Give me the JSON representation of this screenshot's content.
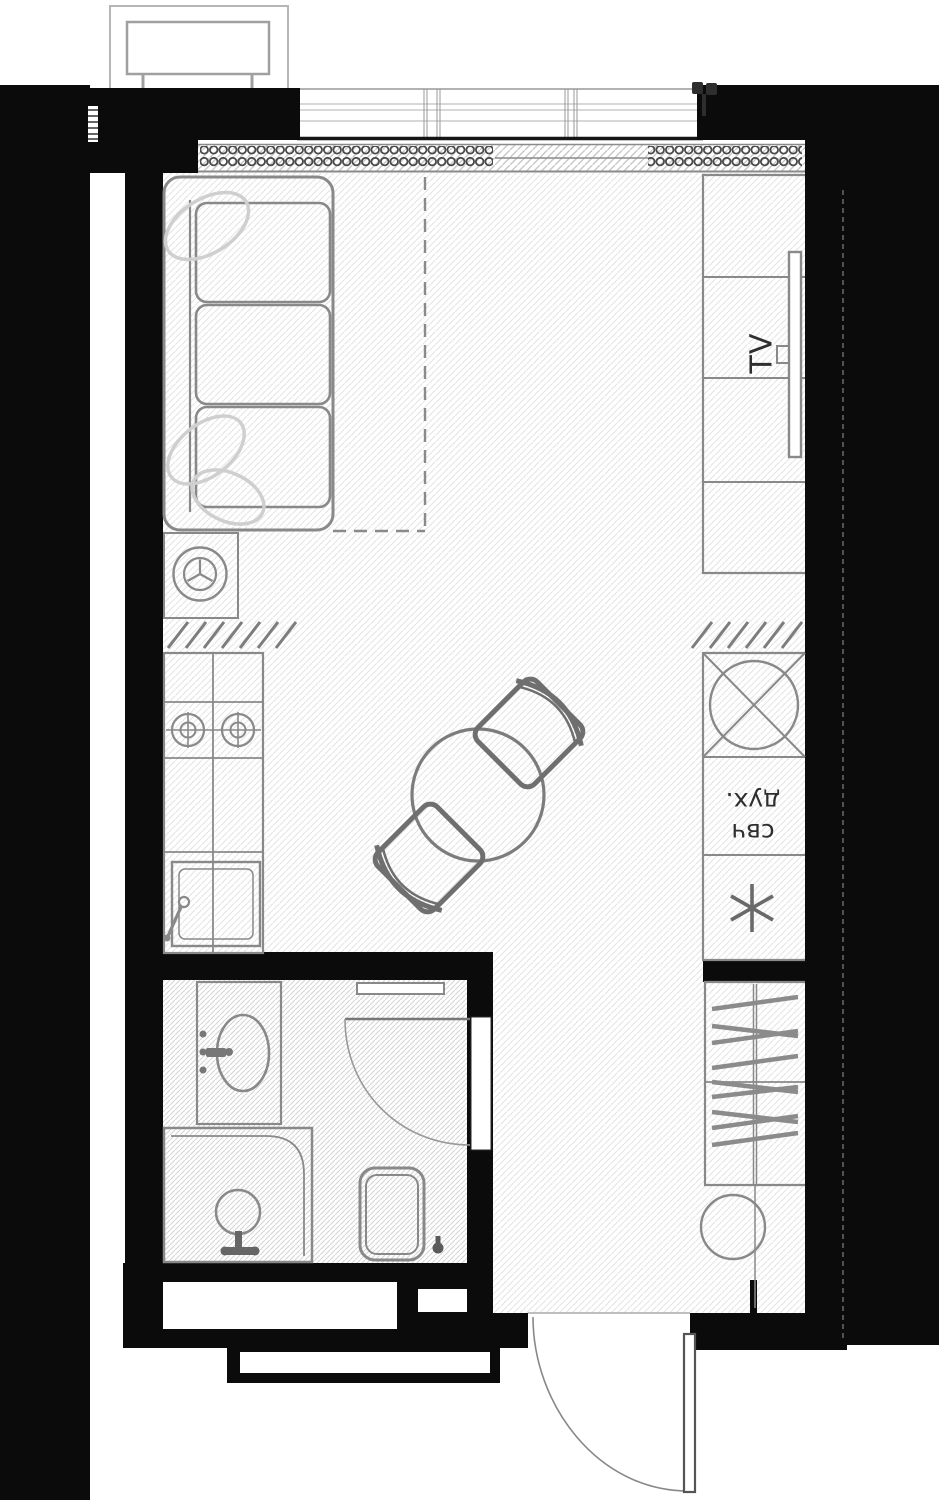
{
  "plan": {
    "labels": {
      "tv": "TV",
      "oven": "дух.",
      "microwave": "свч"
    },
    "colors": {
      "wall": "#0b0b0b",
      "furniture_line": "#898989",
      "light_outline": "#cfcfcf",
      "floor_hatch": "#e4e4e4",
      "bath_hatch": "#d5d5d5",
      "text": "#2f2f2f"
    }
  }
}
